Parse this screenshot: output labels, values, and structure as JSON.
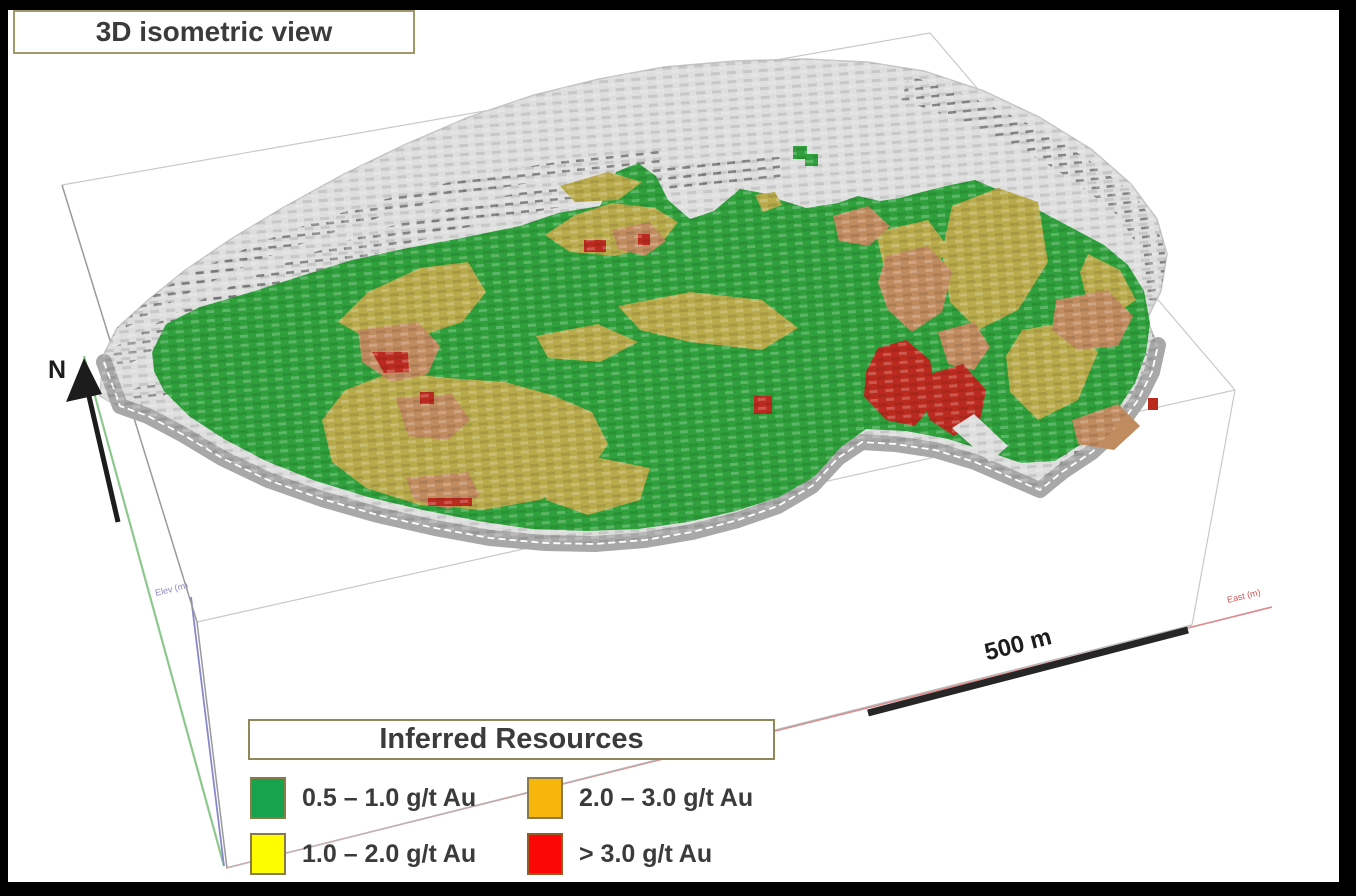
{
  "title_box": {
    "label": "3D isometric view"
  },
  "scene": {
    "north_label": "N",
    "scale_label": "500 m",
    "elev_axis_label": "Elev (m)",
    "east_axis_label": "East (m)"
  },
  "legend": {
    "title": "Inferred Resources",
    "items": [
      {
        "label": "0.5 – 1.0 g/t Au",
        "color": "#17a34e"
      },
      {
        "label": "2.0 – 3.0 g/t Au",
        "color": "#f6b60b"
      },
      {
        "label": "1.0 – 2.0 g/t Au",
        "color": "#fdfd00"
      },
      {
        "label": "> 3.0 g/t Au",
        "color": "#fb0806"
      }
    ]
  },
  "colors": {
    "frame": "#000000",
    "panel": "#ffffff",
    "shell": "#dedede",
    "shell_edge": "#c6c6c6",
    "bench": "#a8a8a8",
    "green_model": "#2fa03c",
    "olive_model": "#b9aa4b",
    "tan_model": "#c08b5f",
    "red_model": "#bb2a1f",
    "axis_north": "#8cc88c",
    "axis_elev": "#8888cc",
    "axis_east": "#dd8a8a",
    "wire_light": "#c9c9c9",
    "wire_dark": "#9a9a9a",
    "ink": "#1d1d1d",
    "text": "#3b3b3b",
    "box_border": "#a39868"
  }
}
